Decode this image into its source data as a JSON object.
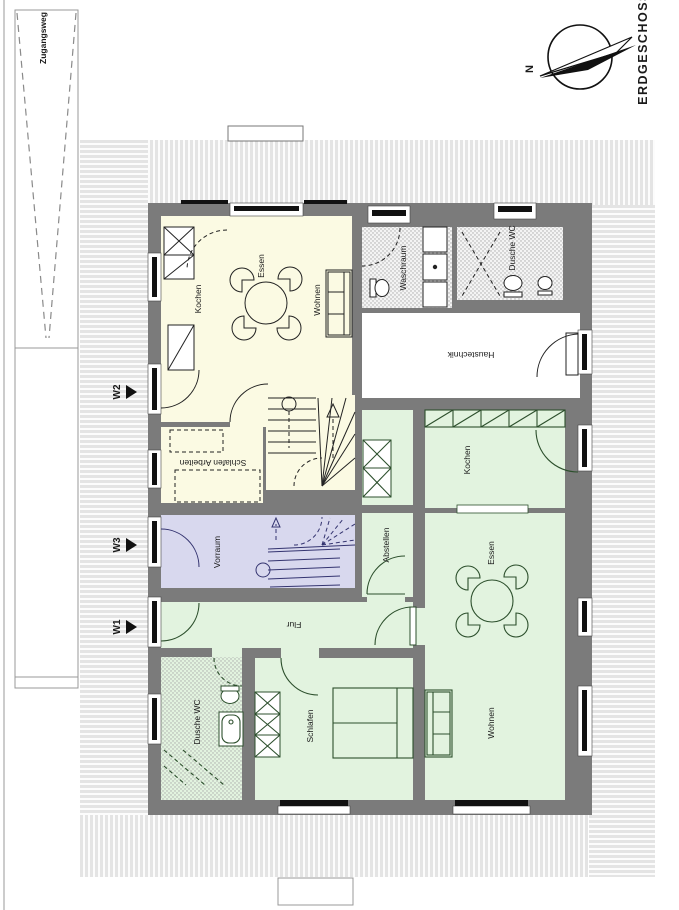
{
  "sheet": {
    "floor_label": "ERDGESCHOSS",
    "north_label": "N",
    "walkway_label": "Zugangsweg"
  },
  "entrances": {
    "w1": "W1",
    "w2": "W2",
    "w3": "W3"
  },
  "rooms": {
    "upper_unit": {
      "kochen": "Kochen",
      "essen": "Essen",
      "wohnen": "Wohnen",
      "schlafen_arbeiten": "Schlafen Arbeiten"
    },
    "common": {
      "waschraum": "Waschraum",
      "dusche_wc": "Dusche WC",
      "haustechnik": "Haustechnik",
      "vorraum": "Vorraum"
    },
    "ground_unit": {
      "kochen": "Kochen",
      "essen": "Essen",
      "wohnen": "Wohnen",
      "schlafen": "Schlafen",
      "dusche_wc": "Dusche WC",
      "flur": "Flur",
      "abstellen": "Abstellen"
    }
  },
  "colors": {
    "wall": "#7b7b7b",
    "room_yellow": "#fbfae3",
    "room_green": "#e2f3df",
    "room_purple": "#d8d8ee",
    "room_white": "#ffffff",
    "stipple_base": "#f4f4f4",
    "stipple_dot": "#a9a9a9",
    "hatch_base": "#e4e4e4",
    "ink": "#1a1a1a",
    "furniture_dark": "#222222",
    "furniture_green": "#2c4f2c",
    "furniture_purple": "#343470",
    "window_glass": "#111111"
  }
}
